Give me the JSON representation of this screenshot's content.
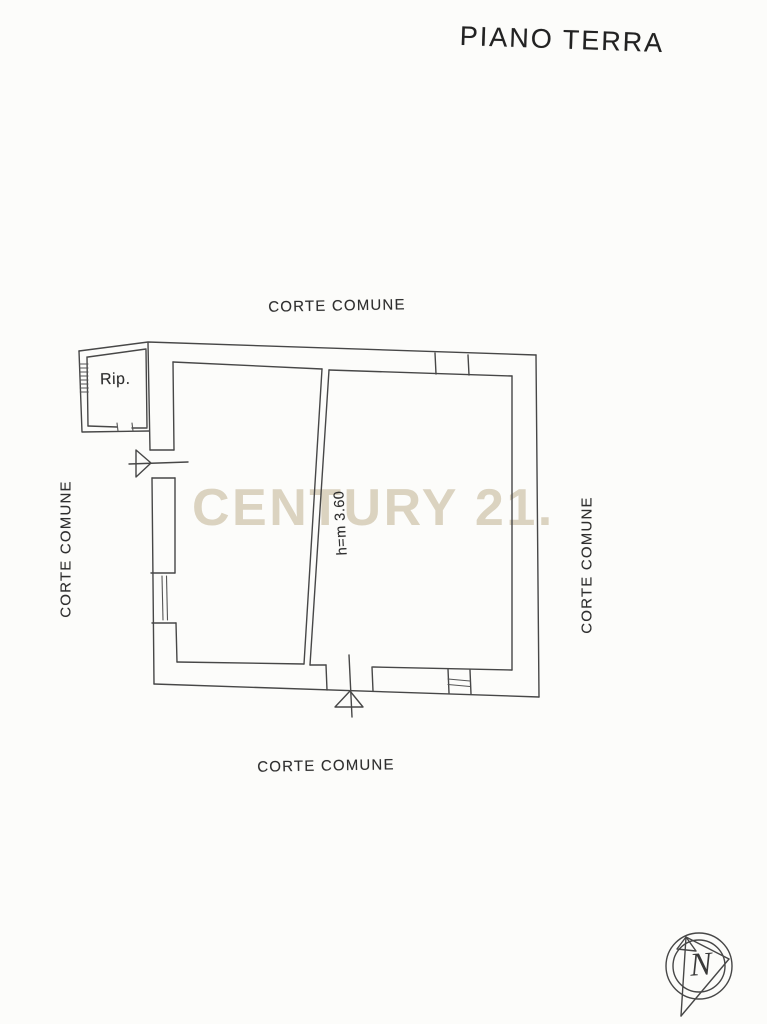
{
  "page": {
    "title": "PIANO TERRA",
    "background": "#fcfcfa",
    "line_color": "#474747",
    "text_color": "#2e2e2e"
  },
  "watermark": {
    "text": "CENTURY 21.",
    "color": "#dbd3c0"
  },
  "labels": {
    "courtyard_top": "CORTE COMUNE",
    "courtyard_bottom": "CORTE COMUNE",
    "courtyard_left": "CORTE COMUNE",
    "courtyard_right": "CORTE COMUNE",
    "storage_room": "Rip.",
    "ceiling_height": "h=m 3.60"
  },
  "compass": {
    "letter": "N"
  }
}
